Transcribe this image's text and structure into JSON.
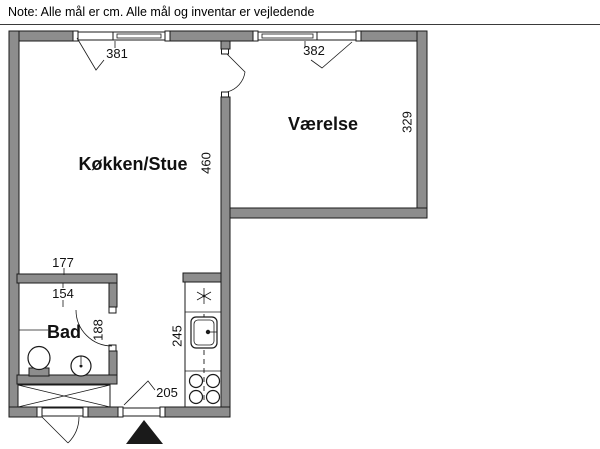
{
  "note": "Note: Alle mål er cm. Alle mål og inventar er vejledende",
  "rooms": {
    "living": {
      "label": "Køkken/Stue"
    },
    "bedroom": {
      "label": "Værelse"
    },
    "bath": {
      "label": "Bad"
    }
  },
  "dims": {
    "window_left": "381",
    "window_right": "382",
    "living_depth": "460",
    "bedroom_depth": "329",
    "bath_outer_width": "177",
    "bath_inner_width": "154",
    "bath_depth": "188",
    "kitchen_run": "245",
    "entrance_width": "205"
  },
  "icons": {
    "fridge": "snowflake-icon",
    "kitchen_sink": "sink-basin-icon",
    "stove": "four-burners-icon",
    "toilet": "toilet-icon",
    "bath_sink": "washbasin-icon",
    "wardrobe": "crossed-box-icon",
    "entrance": "entrance-arrow-icon"
  },
  "colors": {
    "wall_fill": "#8d8d8d",
    "line": "#1a1a1a",
    "background": "#ffffff"
  }
}
